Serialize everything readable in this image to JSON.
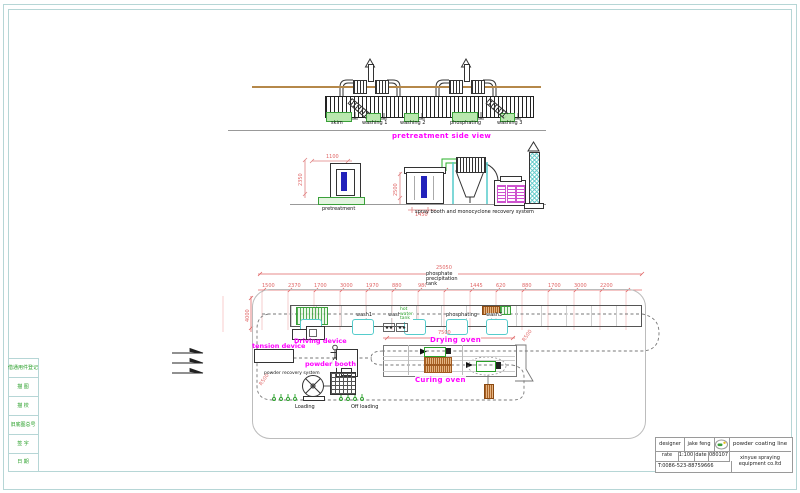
{
  "drawing": {
    "side_view": {
      "title": "pretreatment side view",
      "tank_labels": [
        "skim",
        "washing 1",
        "washing 2",
        "phosphating",
        "washing 3"
      ]
    },
    "elevation": {
      "pretreatment_label": "pretreatment",
      "spray_system_label": "spray booth and monocyclone recovery system",
      "dims": [
        "2350",
        "1100",
        "2500",
        "1450"
      ]
    },
    "plan": {
      "note_lines": [
        "phosphate",
        "precipitation",
        "tank"
      ],
      "hot_water_lines": [
        "hot",
        "water",
        "tank"
      ],
      "station_labels": [
        "wash1",
        "wash2",
        "phosphating",
        "wash3"
      ],
      "driving_device": "Driving device",
      "tension_device": "tension device",
      "powder_booth": "powder booth",
      "powder_recovery": "powder recovery system",
      "drying_oven": "Drying oven",
      "curing_oven": "Curing oven",
      "loading": "Loading",
      "off_loading": "Off loading",
      "total_dim": "25050",
      "oven_dim": "7500",
      "radius_dim": "R500",
      "left_dim": "4000",
      "top_dims": [
        "1500",
        "2370",
        "1700",
        "3000",
        "1970",
        "880",
        "980",
        "1445",
        "620",
        "880",
        "1700",
        "3000",
        "2200"
      ]
    },
    "left_strip": [
      "借通用件登记",
      "描 图",
      "描 校",
      "旧底图总号",
      "签 字",
      "日 期"
    ],
    "title_block": {
      "designer_label": "designer",
      "designer_value": "jake feng",
      "project": "powder coating line",
      "scale_label": "rate",
      "scale_value": "1:100",
      "date_label": "date",
      "date_value": "080107",
      "phone": "T:0086-523-88759666",
      "company_line1": "xinyue spraying",
      "company_line2": "equipment co.ltd"
    },
    "colors": {
      "magenta": "#ff00ff",
      "green": "#3aa03a",
      "red_dim": "#e06666",
      "cyan": "#55cccc",
      "blue": "#2222bb",
      "brown": "#b5884a",
      "frame": "#b6d6d6"
    }
  }
}
